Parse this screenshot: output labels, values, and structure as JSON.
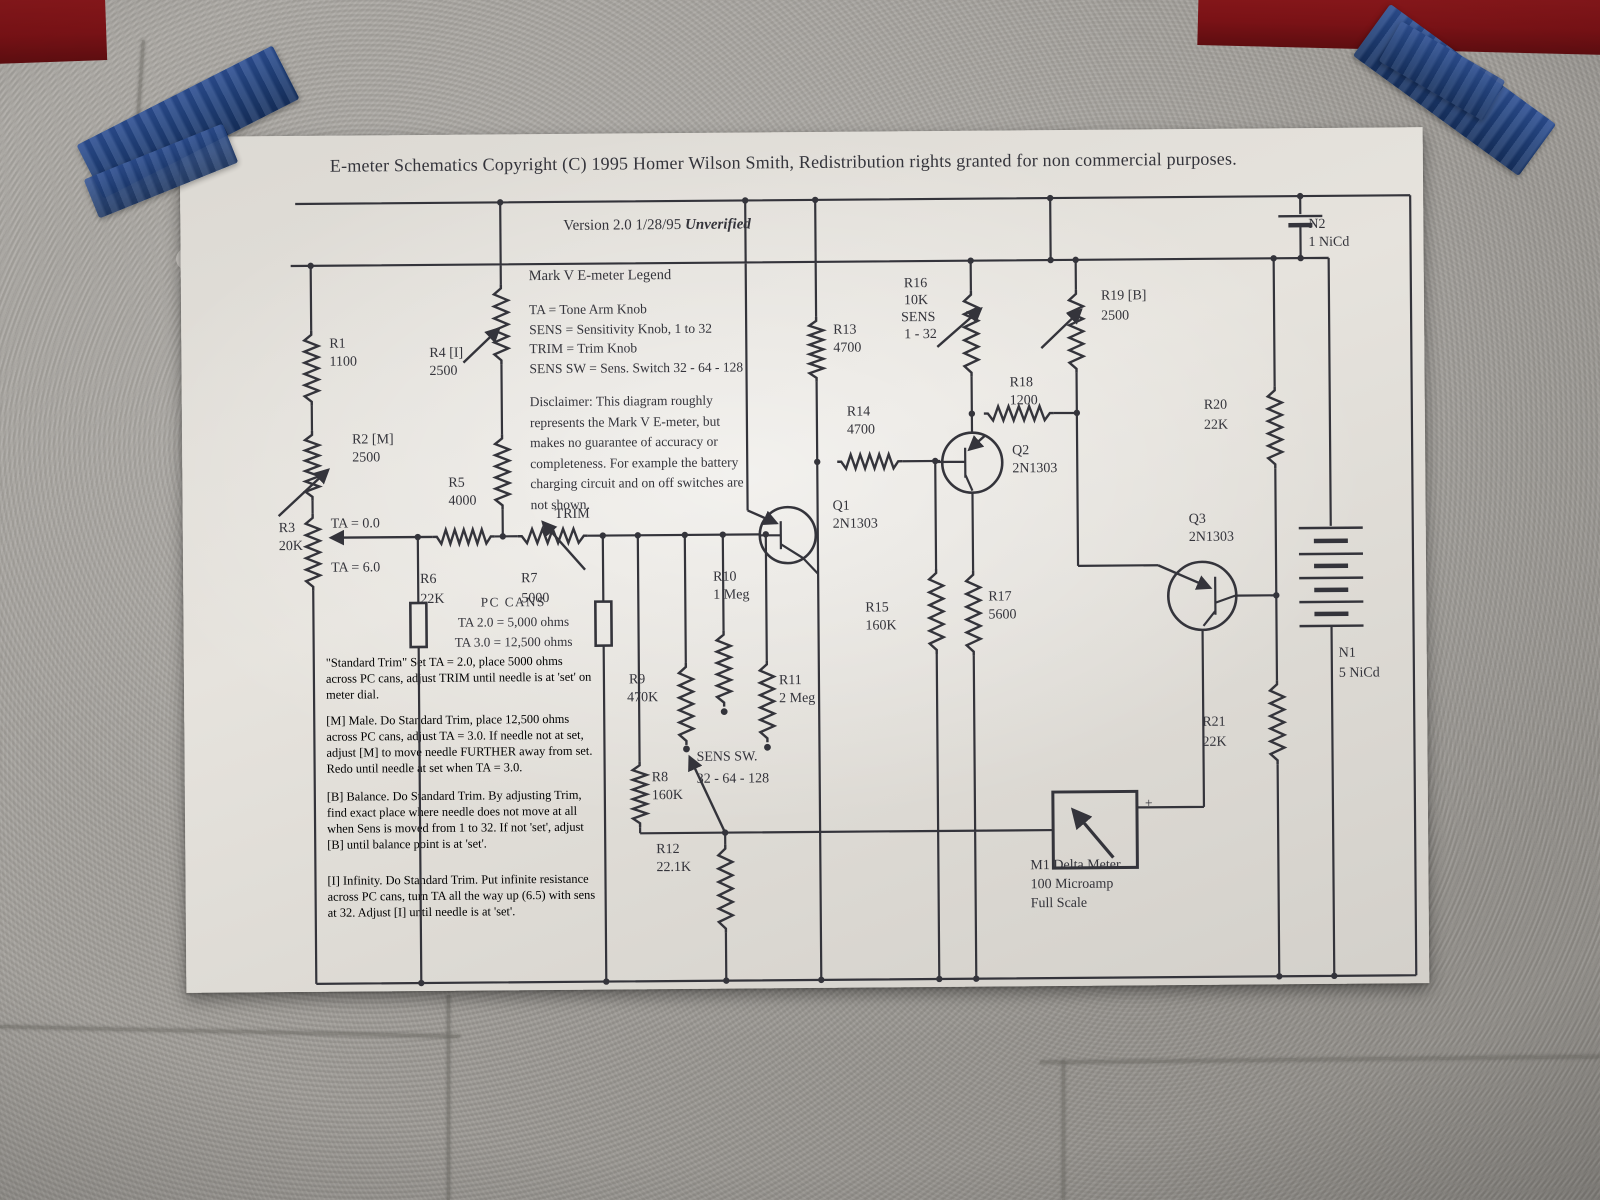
{
  "colors": {
    "wall": "#a3a09b",
    "red": "#7a1216",
    "tape": "#20407a",
    "paper": "#e6e3dd",
    "ink": "#34343b"
  },
  "paper": {
    "title": "E-meter Schematics Copyright (C) 1995 Homer Wilson Smith, Redistribution rights granted for non commercial purposes.",
    "version": {
      "text": "Version 2.0 1/28/95 ",
      "flag": "Unverified"
    },
    "legend": {
      "heading": "Mark V E-meter Legend",
      "lines": [
        "TA = Tone Arm Knob",
        "SENS = Sensitivity Knob, 1 to 32",
        "TRIM = Trim Knob",
        "SENS SW = Sens. Switch 32 - 64 - 128"
      ]
    },
    "disclaimer": {
      "lines": [
        "Disclaimer:  This diagram roughly",
        "represents the Mark V E-meter, but",
        "makes no guarantee of accuracy or",
        "completeness.  For example the battery",
        "charging circuit and on off switches are",
        "not shown."
      ]
    },
    "pc_cans": {
      "heading": "PC CANS",
      "lines": [
        "TA 2.0 = 5,000 ohms",
        "TA 3.0 = 12,500 ohms"
      ]
    },
    "notes": [
      {
        "lines": [
          "\"Standard Trim\"  Set TA = 2.0, place 5000 ohms",
          "across PC cans, adjust TRIM until needle is at 'set' on",
          "meter dial."
        ]
      },
      {
        "lines": [
          "[M] Male. Do Standard Trim, place 12,500 ohms",
          "across PC cans, adjust TA = 3.0.  If needle not at set,",
          "adjust [M] to move needle FURTHER away from set.",
          "Redo until needle at set when TA = 3.0."
        ]
      },
      {
        "lines": [
          "[B] Balance. Do Standard Trim.  By adjusting Trim,",
          "find exact place where needle does not move at all",
          "when Sens is moved from 1 to 32.  If not 'set', adjust",
          "[B] until balance point is at 'set'."
        ]
      },
      {
        "lines": [
          "[I] Infinity. Do Standard Trim.  Put infinite resistance",
          "across PC cans, turn TA all the way up (6.5) with sens",
          "at 32.  Adjust [I] until needle is at 'set'."
        ]
      }
    ],
    "meter": {
      "lines": [
        "M1 Delta Meter",
        "100 Microamp",
        "Full Scale"
      ],
      "plus": "+"
    },
    "components": {
      "r1": {
        "id": "R1",
        "value": "1100"
      },
      "r2": {
        "id": "R2 [M]",
        "value": "2500"
      },
      "r3": {
        "id": "R3",
        "value": "20K"
      },
      "r4": {
        "id": "R4 [I]",
        "value": "2500"
      },
      "r5": {
        "id": "R5",
        "value": "4000"
      },
      "r6": {
        "id": "R6",
        "value": "22K"
      },
      "r7": {
        "id": "R7",
        "value": "5000"
      },
      "r8": {
        "id": "R8",
        "value": "160K"
      },
      "r9": {
        "id": "R9",
        "value": "470K"
      },
      "r10": {
        "id": "R10",
        "value": "1 Meg"
      },
      "r11": {
        "id": "R11",
        "value": "2 Meg"
      },
      "r12": {
        "id": "R12",
        "value": "22.1K"
      },
      "r13": {
        "id": "R13",
        "value": "4700"
      },
      "r14": {
        "id": "R14",
        "value": "4700"
      },
      "r15": {
        "id": "R15",
        "value": "160K"
      },
      "r16": {
        "id": "R16",
        "value": "10K",
        "extra1": "SENS",
        "extra2": "1 - 32"
      },
      "r17": {
        "id": "R17",
        "value": "5600"
      },
      "r18": {
        "id": "R18",
        "value": "1200"
      },
      "r19": {
        "id": "R19 [B]",
        "value": "2500"
      },
      "r20": {
        "id": "R20",
        "value": "22K"
      },
      "r21": {
        "id": "R21",
        "value": "22K"
      },
      "q1": {
        "id": "Q1",
        "value": "2N1303"
      },
      "q2": {
        "id": "Q2",
        "value": "2N1303"
      },
      "q3": {
        "id": "Q3",
        "value": "2N1303"
      },
      "n1": {
        "id": "N1",
        "value": "5 NiCd"
      },
      "n2": {
        "id": "N2",
        "value": "1 NiCd"
      },
      "ta_high": "TA = 0.0",
      "ta_low": "TA = 6.0",
      "trim": "TRIM",
      "sens_sw": {
        "line1": "SENS SW.",
        "line2": "32 - 64 - 128"
      }
    }
  }
}
